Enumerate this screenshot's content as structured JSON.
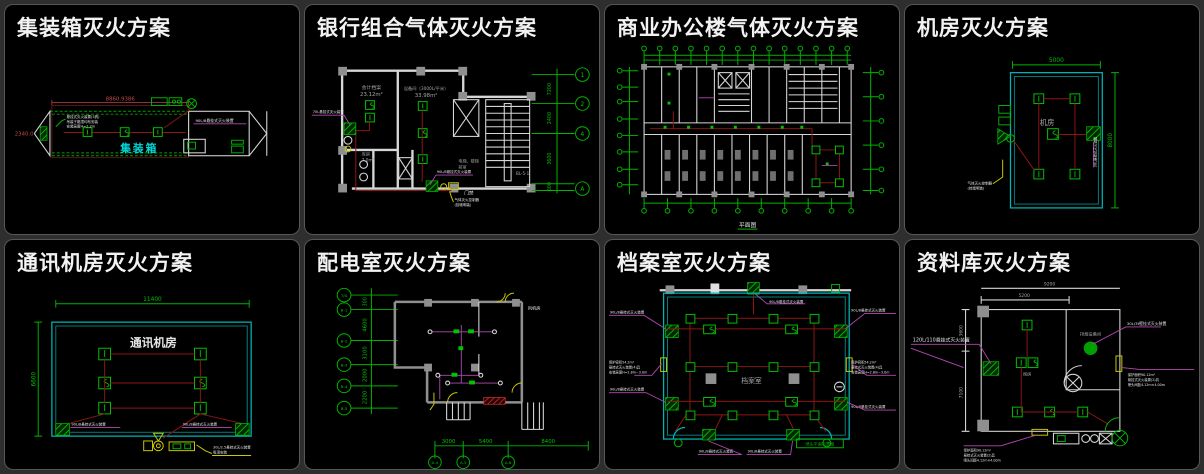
{
  "window": {
    "background": "#000000",
    "frame": "#2e2e2e"
  },
  "colors": {
    "green": "#00b400",
    "cyan_wall": "#00b4b4",
    "pipe_red": "#8f1515",
    "dim_red": "#c84848",
    "magenta": "#b648b6",
    "yellow": "#c9c900",
    "wall_white": "#d6d6d6",
    "wall_gray": "#8f8f8f"
  },
  "panels": [
    {
      "title": "集装箱灭火方案",
      "labels": {
        "room": "集装箱",
        "dim_top": "8860.9386",
        "dim_left": "2340.0",
        "device": "90L/8悬挂式灭火装置",
        "note1": "悬挂式灭火装置(3具)",
        "note2": "吊装于箱顶均布安装",
        "note3": "安装高度H=2.2m"
      }
    },
    {
      "title": "银行组合气体灭火方案",
      "labels": {
        "room1": "会计档案",
        "area1": "23.12m²",
        "room2": "设备间（3000L/平米）",
        "area2": "33.98m²",
        "room3": "库房",
        "area3": "7.0m²",
        "lobby1": "电梯、楼梯",
        "lobby2": "前室",
        "stair": "BL-5-1",
        "door": "门禁",
        "leader_left": "70L悬挂式灭火装置",
        "leader_mid": "90L/8悬挂式灭火装置",
        "leader_bottom1": "气体灭火控制器",
        "leader_bottom2": "(挂墙明装)",
        "dims_right": [
          "7200",
          "2400",
          "3600",
          "600"
        ],
        "axes_right": [
          "1",
          "2",
          "4",
          "A"
        ]
      }
    },
    {
      "title": "商业办公楼气体灭火方案",
      "labels": {
        "caption": "平面图"
      }
    },
    {
      "title": "机房灭火方案",
      "labels": {
        "room": "机房",
        "dim_top": "5000",
        "dim_right": "8000",
        "device": "30L悬挂式灭火装置",
        "note1": "气体灭火控制器",
        "note2": "(挂墙明装)"
      }
    },
    {
      "title": "通讯机房灭火方案",
      "labels": {
        "room": "通讯机房",
        "dim_top": "11400",
        "dim_left": "6600",
        "device_left": "90L/8悬挂式灭火装置",
        "device_right": "90L/8悬挂式灭火装置",
        "note1": "30L/2.5悬挂式灭火装置",
        "note2": "吸顶安装"
      }
    },
    {
      "title": "配电室灭火方案",
      "labels": {
        "fan_room": "风机房",
        "dims_left": [
          "300",
          "4600",
          "3100",
          "2000",
          "2200"
        ],
        "dims_bottom": [
          "3000",
          "5400",
          "8400"
        ],
        "axes_left": [
          "7/A",
          "B-1",
          "B-2",
          "B-3",
          "B-4",
          "B-5"
        ],
        "axes_bottom": [
          "A-4",
          "A-5",
          "A-6"
        ]
      }
    },
    {
      "title": "档案室灭火方案",
      "labels": {
        "room": "档案室",
        "leader_top": "90L/8悬挂式灭火装置",
        "leader_left_top": "90L/8悬挂式灭火装置",
        "leader_right_top": "90L/8悬挂式灭火装置",
        "leader_left_bottom": "90L/8悬挂式灭火装置",
        "leader_right_bottom": "90L/8悬挂式灭火装置",
        "leader_b1": "90L/8悬挂式灭火装置",
        "leader_b2": "90L/8悬挂式灭火装置",
        "spec_l1": "保护容积54.2m³",
        "spec_l2": "悬挂式灭火装置(4)具",
        "spec_l3": "安装高度H=2.8m~3.0m",
        "spec_r1": "保护容积54.2m³",
        "spec_r2": "悬挂式灭火装置(4)具",
        "spec_r3": "安装高度H=2.8m~3.0m",
        "box_caption": "喷头平面布置图"
      }
    },
    {
      "title": "资料库灭火方案",
      "labels": {
        "dim_top_outer": "9200",
        "dim_top_inner": "5200",
        "dim_left_top": "3600",
        "dim_left_bottom": "7100",
        "device_left": "120L/110悬挂式灭火装置",
        "device_tr": "30L/3t壁挂式灭火装置",
        "room_top": "排烟设备间",
        "room_small": "阀房",
        "spec_r1": "保护面积90.12m²",
        "spec_r2": "悬挂式灭火装置(2)具",
        "spec_r3": "喷头间距4.12m×4.00m",
        "spec_b1": "保护面积90.12m²",
        "spec_b2": "悬挂式灭火装置(2)具",
        "spec_b3": "喷头间距4.12m×4.00m"
      }
    }
  ]
}
